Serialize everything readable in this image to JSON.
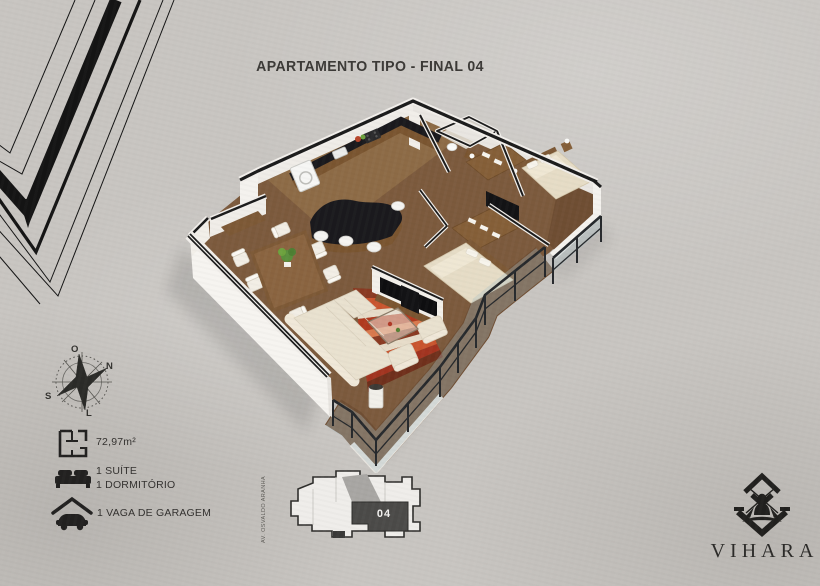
{
  "header": {
    "title": "APARTAMENTO TIPO - FINAL 04"
  },
  "compass": {
    "west": "O",
    "north": "N",
    "south": "S",
    "east": "L"
  },
  "legend": {
    "area": {
      "icon": "floorplan-icon",
      "value": "72,97m²"
    },
    "rooms": {
      "icon": "bed-icon",
      "line1": "1 SUÍTE",
      "line2": "1 DORMITÓRIO"
    },
    "garage": {
      "icon": "garage-icon",
      "label": "1 VAGA DE GARAGEM"
    }
  },
  "keyplan": {
    "street": "AV. OSVALDO ARANHA",
    "unit": "04"
  },
  "brand": {
    "name": "VIHARA",
    "logo": "vihara-meditation-logo"
  },
  "icons": {
    "legend": [
      "floorplan-icon",
      "bed-icon",
      "garage-icon"
    ],
    "compass": "compass-rose",
    "decor": "chevron-corner-pattern"
  },
  "colors": {
    "background": "#c8c5c1",
    "ink": "#222120",
    "wall_white": "#f2efeb",
    "wall_cap": "#1b1b1b",
    "wood_floor": "#7c5a3d",
    "kitchen_wood": "#8d6b46",
    "deck_wood": "#6f4e33",
    "granite": "#1a191d",
    "rug_red": "#b03a1f",
    "upholstery": "#e9e1cf",
    "bedding": "#e6dcc6",
    "railing": "#26292c",
    "keyplan_unit_fill": "#4b4a48"
  }
}
